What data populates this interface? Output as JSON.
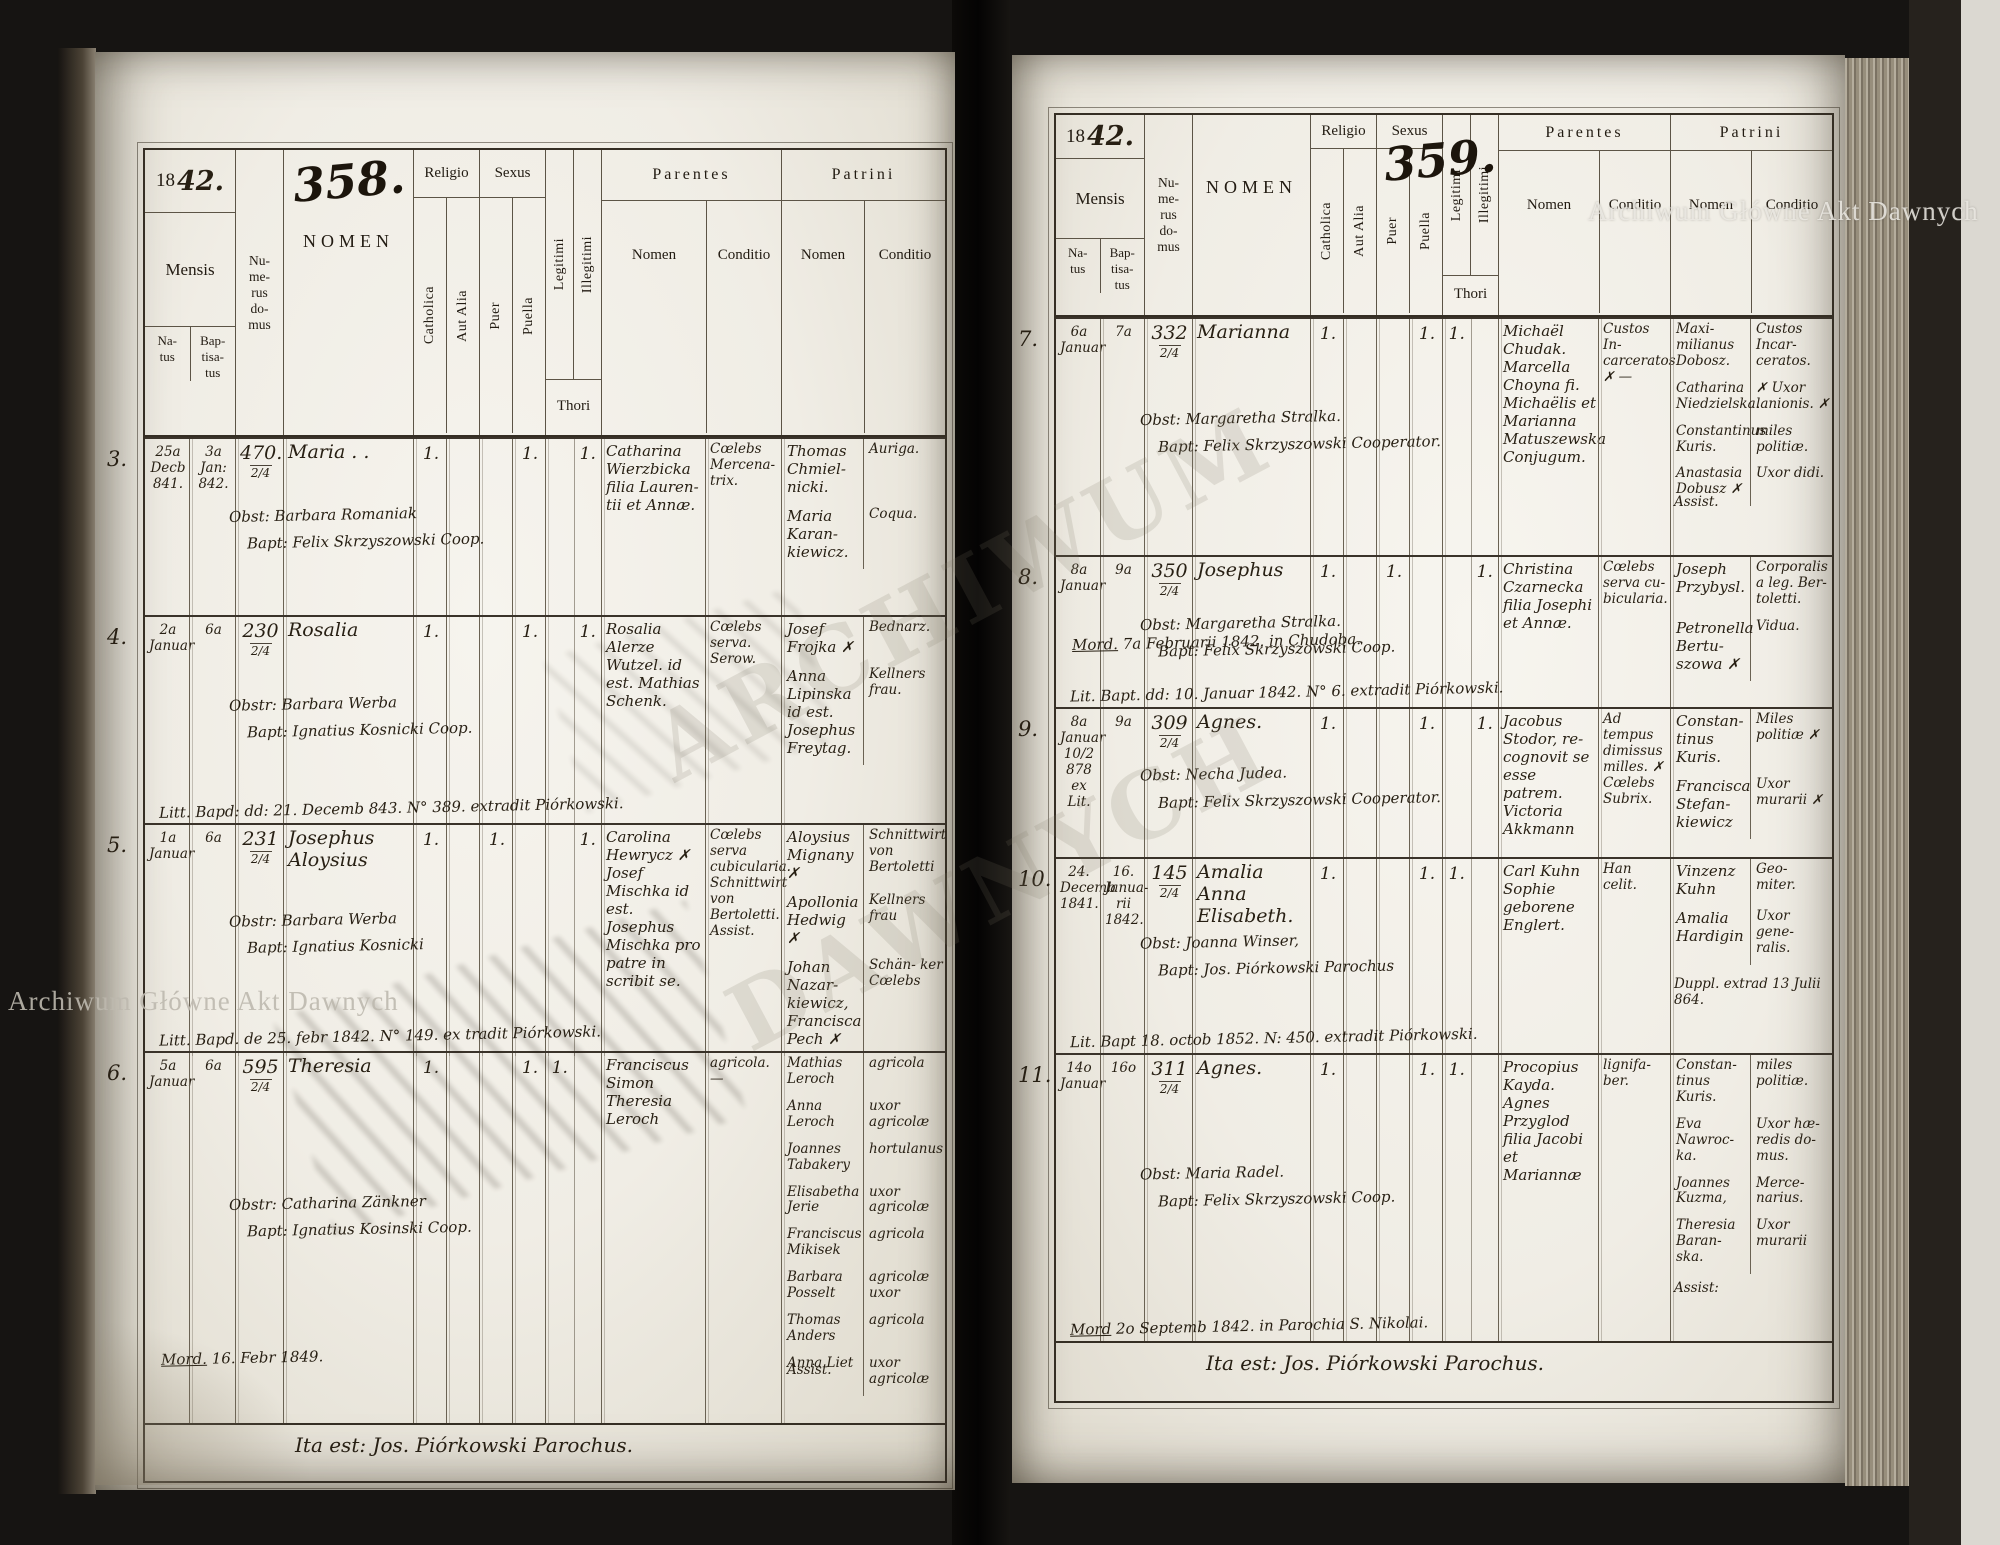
{
  "watermark": {
    "text": "Archiwum Główne Akt Dawnych"
  },
  "ghost": {
    "line1": "ARCHIWUM",
    "line2": "DAWNYCH"
  },
  "columns": {
    "year_printed": "18",
    "mensis": "Mensis",
    "natus": "Na-\ntus",
    "baptisatus": "Bap-\ntisa-\ntus",
    "numerus": "Nu-\nme-\nrus\ndo-\nmus",
    "nomen": "NOMEN",
    "religio": "Religio",
    "catholica": "Catholica",
    "aut_alia": "Aut Alia",
    "sexus": "Sexus",
    "puer": "Puer",
    "puella": "Puella",
    "legitimi": "Legitimi",
    "illegitimi": "Illegitimi",
    "thori": "Thori",
    "parentes": "Parentes",
    "patrini": "Patrini",
    "sub_nomen": "Nomen",
    "sub_conditio": "Conditio"
  },
  "pages": {
    "left": {
      "page_number": "358.",
      "year_hand": "42.",
      "footer": "Ita est: Jos. Piórkowski Parochus.",
      "entries": [
        {
          "no": "3.",
          "natus": "25a\nDecb\n841.",
          "baptisatus": "3a\nJan:\n842.",
          "domus": "470.",
          "domus_frac": "2/4",
          "nomen": "Maria . .",
          "catholica": "1.",
          "puella": "1.",
          "illegitimi": "1.",
          "obst": "Obst: Barbara Romaniak",
          "bapt": "Bapt: Felix Skrzyszowski Coop.",
          "parentes_nomen": "Catharina Wierzbicka filia Lauren- tii et Annæ.",
          "parentes_conditio": "Cœlebs Mercena- trix.",
          "patrini": [
            {
              "n": "Thomas Chmiel- nicki.",
              "c": "Auriga."
            },
            {
              "n": "Maria Karan- kiewicz.",
              "c": "Coqua."
            }
          ]
        },
        {
          "no": "4.",
          "natus": "2a\nJanuar",
          "baptisatus": "6a",
          "domus": "230",
          "domus_frac": "2/4",
          "nomen": "Rosalia",
          "catholica": "1.",
          "puella": "1.",
          "illegitimi": "1.",
          "obst": "Obstr: Barbara Werba",
          "bapt": "Bapt: Ignatius Kosnicki Coop.",
          "parentes_nomen": "Rosalia Alerze Wutzel. id est. Mathias Schenk.",
          "parentes_conditio": "Cœlebs serva. Serow.",
          "patrini": [
            {
              "n": "Josef Frojka ✗",
              "c": "Bednarz."
            },
            {
              "n": "Anna Lipinska id est. Josephus Freytag.",
              "c": "Kellners frau."
            }
          ],
          "note_bottom": "Litt. Bapd: dd: 21. Decemb 843. N° 389. extradit Piórkowski."
        },
        {
          "no": "5.",
          "natus": "1a\nJanuar",
          "baptisatus": "6a",
          "domus": "231",
          "domus_frac": "2/4",
          "nomen": "Josephus Aloysius",
          "catholica": "1.",
          "puer": "1.",
          "illegitimi": "1.",
          "obst": "Obstr: Barbara Werba",
          "bapt": "Bapt: Ignatius Kosnicki",
          "parentes_nomen": "Carolina Hewrycz ✗ Josef Mischka id est. Josephus Mischka pro patre in scribit se.",
          "parentes_conditio": "Cœlebs serva cubicularia. Schnittwirt von Bertoletti. Assist.",
          "patrini": [
            {
              "n": "Aloysius Mignany ✗",
              "c": "Schnittwirt von Bertoletti"
            },
            {
              "n": "Apollonia Hedwig ✗",
              "c": "Kellners frau"
            },
            {
              "n": "Johan Nazar- kiewicz, Francisca Pech ✗",
              "c": "Schän- ker Cœlebs"
            }
          ],
          "note_bottom": "Litt. Bapd. de 25. febr 1842. N° 149. ex tradit Piórkowski."
        },
        {
          "no": "6.",
          "natus": "5a\nJanuar",
          "baptisatus": "6a",
          "domus": "595",
          "domus_frac": "2/4",
          "nomen": "Theresia",
          "catholica": "1.",
          "puella": "1.",
          "legitimi": "1.",
          "obst": "Obstr: Catharina Zänkner",
          "bapt": "Bapt: Ignatius Kosinski Coop.",
          "parentes_nomen": "Franciscus Simon Theresia Leroch",
          "parentes_conditio": "agricola. —",
          "assist": "Assist.",
          "patrini": [
            {
              "n": "Mathias Leroch",
              "c": "agricola"
            },
            {
              "n": "Anna Leroch",
              "c": "uxor agricolæ"
            },
            {
              "n": "Joannes Tabakery",
              "c": "hortulanus"
            },
            {
              "n": "Elisabetha Jerie",
              "c": "uxor agricolæ"
            },
            {
              "n": "Franciscus Mikisek",
              "c": "agricola"
            },
            {
              "n": "Barbara Posselt",
              "c": "agricolæ uxor"
            },
            {
              "n": "Thomas Anders",
              "c": "agricola"
            },
            {
              "n": "Anna Liet",
              "c": "uxor agricolæ"
            }
          ],
          "note_mid_u": "Mord.",
          "note_mid": " 16. Febr 1849."
        }
      ]
    },
    "right": {
      "page_number": "359.",
      "year_hand": "42.",
      "footer": "Ita est: Jos. Piórkowski Parochus.",
      "entries": [
        {
          "no": "7.",
          "natus": "6a\nJanuar",
          "baptisatus": "7a",
          "domus": "332",
          "domus_frac": "2/4",
          "nomen": "Marianna",
          "catholica": "1.",
          "puella": "1.",
          "legitimi": "1.",
          "obst": "Obst: Margaretha Stralka.",
          "bapt": "Bapt: Felix Skrzyszowski Cooperator.",
          "parentes_nomen": "Michaël Chudak. Marcella Choyna fi. Michaëlis et Marianna Matuszewska Conjugum.",
          "parentes_conditio": "Custos In- carceratos ✗ —",
          "assist": "Assist.",
          "patrini": [
            {
              "n": "Maxi- milianus Dobosz.",
              "c": "Custos Incar- ceratos."
            },
            {
              "n": "Catharina Niedzielska.",
              "c": "✗ Uxor lanionis. ✗"
            },
            {
              "n": "Constantinus Kuris.",
              "c": "miles politiæ."
            },
            {
              "n": "Anastasia Dobusz ✗",
              "c": "Uxor didi."
            }
          ]
        },
        {
          "no": "8.",
          "natus": "8a\nJanuar",
          "baptisatus": "9a",
          "domus": "350",
          "domus_frac": "2/4",
          "nomen": "Josephus",
          "catholica": "1.",
          "puer": "1.",
          "illegitimi": "1.",
          "obst": "Obst: Margaretha Stralka.",
          "bapt": "Bapt: Felix Skrzyszowski Coop.",
          "parentes_nomen": "Christina Czarnecka filia Josephi et Annæ.",
          "parentes_conditio": "Cœlebs serva cu- bicularia.",
          "patrini": [
            {
              "n": "Joseph Przybysl.",
              "c": "Corporalis a leg. Ber- toletti."
            },
            {
              "n": "Petronella Bertu- szowa ✗",
              "c": "Vidua."
            }
          ],
          "note_mid_u": "Mord.",
          "note_mid": " 7a Februarii 1842. in Chudoba.",
          "note_bottom": "Lit. Bapt. dd: 10. Januar 1842. N° 6. extradit Piórkowski."
        },
        {
          "no": "9.",
          "natus": "8a\nJanuar\n10/2 878\nex Lit.",
          "baptisatus": "9a",
          "domus": "309",
          "domus_frac": "2/4",
          "nomen": "Agnes.",
          "catholica": "1.",
          "puella": "1.",
          "illegitimi": "1.",
          "obst": "Obst: Necha Judea.",
          "bapt": "Bapt: Felix Skrzyszowski Cooperator.",
          "parentes_nomen": "Jacobus Stodor, re- cognovit se esse patrem. Victoria Akkmann",
          "parentes_conditio": "Ad tempus dimissus milles. ✗ Cœlebs Subrix.",
          "patrini": [
            {
              "n": "Constan- tinus Kuris.",
              "c": "Miles politiæ ✗"
            },
            {
              "n": "Francisca Stefan- kiewicz",
              "c": "Uxor murarii ✗"
            }
          ]
        },
        {
          "no": "10.",
          "natus": "24.\nDecemb\n1841.",
          "baptisatus": "16.\nJanua-\nrii\n1842.",
          "domus": "145",
          "domus_frac": "2/4",
          "nomen": "Amalia Anna Elisabeth.",
          "catholica": "1.",
          "puella": "1.",
          "legitimi": "1.",
          "obst": "Obst: Joanna Winser,",
          "bapt": "Bapt: Jos. Piórkowski Parochus",
          "parentes_nomen": "Carl Kuhn Sophie geborene Englert.",
          "parentes_conditio": "Han celit.",
          "assist": "Duppl. extrad 13 Julii 864.",
          "patrini": [
            {
              "n": "Vinzenz Kuhn",
              "c": "Geo- miter."
            },
            {
              "n": "Amalia Hardigin",
              "c": "Uxor gene- ralis."
            }
          ],
          "note_bottom": "Lit. Bapt 18. octob 1852. N: 450. extradit Piórkowski."
        },
        {
          "no": "11.",
          "natus": "14o\nJanuar",
          "baptisatus": "16o",
          "domus": "311",
          "domus_frac": "2/4",
          "nomen": "Agnes.",
          "catholica": "1.",
          "puella": "1.",
          "legitimi": "1.",
          "obst": "Obst: Maria Radel.",
          "bapt": "Bapt: Felix Skrzyszowski Coop.",
          "parentes_nomen": "Procopius Kayda. Agnes Przyglod filia Jacobi et Mariannæ",
          "parentes_conditio": "lignifa- ber.",
          "assist": "Assist:",
          "patrini": [
            {
              "n": "Constan- tinus Kuris.",
              "c": "miles politiæ."
            },
            {
              "n": "Eva Nawroc- ka.",
              "c": "Uxor hæ- redis do- mus."
            },
            {
              "n": "Joannes Kuzma,",
              "c": "Merce- narius."
            },
            {
              "n": "Theresia Baran- ska.",
              "c": "Uxor murarii"
            }
          ],
          "note_bottom_u": "Mord",
          "note_bottom": " 2o Septemb 1842. in Parochia S. Nikolai."
        }
      ]
    }
  }
}
